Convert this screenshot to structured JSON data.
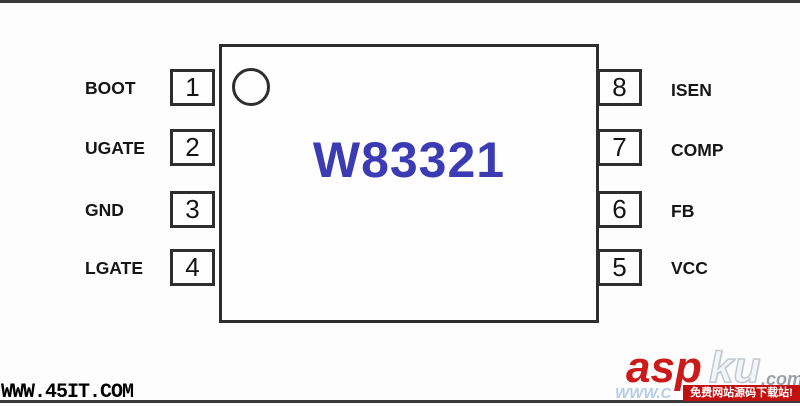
{
  "diagram": {
    "chip_name": "W83321",
    "left_pins": [
      {
        "number": "1",
        "label": "BOOT"
      },
      {
        "number": "2",
        "label": "UGATE"
      },
      {
        "number": "3",
        "label": "GND"
      },
      {
        "number": "4",
        "label": "LGATE"
      }
    ],
    "right_pins": [
      {
        "number": "8",
        "label": "ISEN"
      },
      {
        "number": "7",
        "label": "COMP"
      },
      {
        "number": "6",
        "label": "FB"
      },
      {
        "number": "5",
        "label": "VCC"
      }
    ]
  },
  "watermarks": {
    "bottom_left_url": "WWW.45IT.COM",
    "logo_asp": "asp",
    "logo_ku": "ku",
    "logo_tld": ".com",
    "logo_banner": "免费网站源码下载站!",
    "logo_partial_url": "WWW.C"
  },
  "colors": {
    "chip_name_blue": "#3b3bb3",
    "line_dark": "#3a3a3a",
    "logo_red": "#cb1a1a",
    "banner_red": "#c01010",
    "partial_url_blue": "#b5cbe8"
  }
}
